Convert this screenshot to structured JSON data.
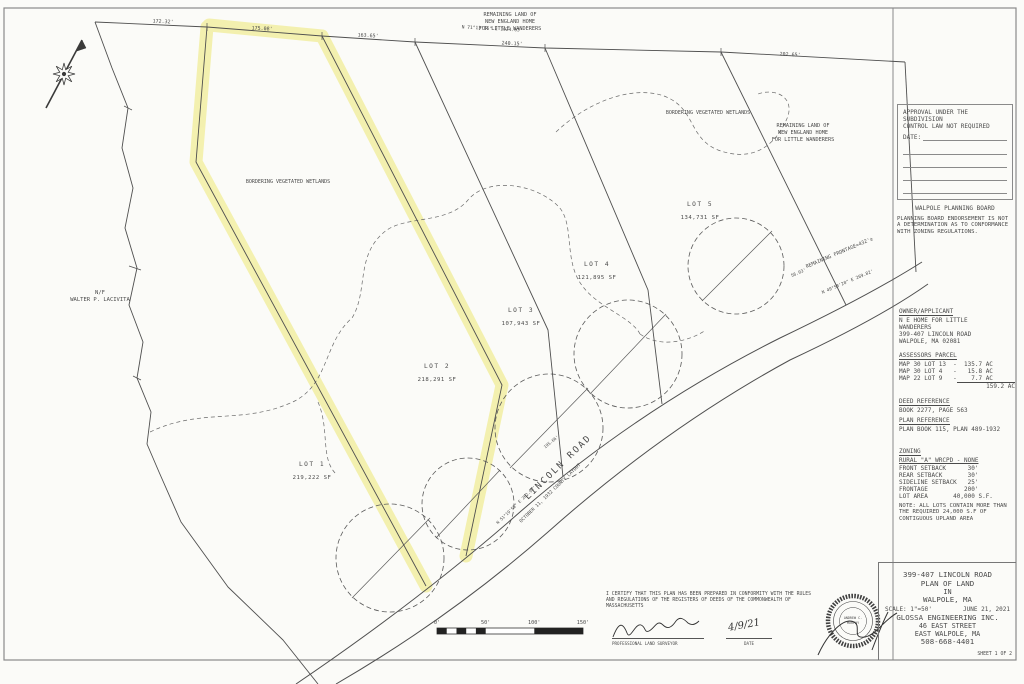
{
  "approval": {
    "line1": "APPROVAL UNDER THE SUBDIVISION",
    "line2": "CONTROL LAW NOT REQUIRED",
    "date_label": "DATE:",
    "board": "WALPOLE PLANNING BOARD",
    "endorsement": "PLANNING BOARD ENDORSEMENT IS NOT A DETERMINATION AS TO CONFORMANCE WITH ZONING REGULATIONS."
  },
  "owner": {
    "heading": "OWNER/APPLICANT",
    "lines": [
      "N E HOME FOR LITTLE",
      "WANDERERS",
      "399-407 LINCOLN ROAD",
      "WALPOLE, MA 02081"
    ]
  },
  "assessors": {
    "heading": "ASSESSORS PARCEL",
    "rows": [
      "MAP 30 LOT 13  -  135.7 AC",
      "MAP 30 LOT 4   -   15.8 AC",
      "MAP 22 LOT 9   -    7.7 AC"
    ],
    "total": "159.2 AC"
  },
  "deed": {
    "heading": "DEED REFERENCE",
    "value": "BOOK 2277, PAGE 563"
  },
  "plan_ref": {
    "heading": "PLAN REFERENCE",
    "value": "PLAN BOOK 115, PLAN 489-1932"
  },
  "zoning": {
    "heading": "ZONING",
    "district": "RURAL \"A\"  WRCPD - NONE",
    "rows": [
      "FRONT SETBACK      30'",
      "REAR SETBACK       30'",
      "SIDELINE SETBACK   25'",
      "FRONTAGE          200'",
      "LOT AREA       40,000 S.F."
    ],
    "note": "NOTE: ALL LOTS CONTAIN MORE THAN THE REQUIRED 24,000 S.F OF CONTIGUOUS UPLAND AREA"
  },
  "title_block": {
    "line1": "399-407 LINCOLN ROAD",
    "line2": "PLAN OF LAND",
    "line3": "IN",
    "line4": "WALPOLE, MA",
    "scale": "SCALE: 1\"=50'",
    "date": "JUNE 21, 2021",
    "firm": "GLOSSA ENGINEERING INC.",
    "address1": "46 EAST STREET",
    "address2": "EAST WALPOLE, MA",
    "phone": "508-668-4401",
    "sheet": "SHEET 1 OF 2"
  },
  "certification": {
    "text": "I CERTIFY THAT THIS PLAN HAS BEEN PREPARED IN CONFORMITY WITH THE RULES AND REGULATIONS OF THE REGISTERS OF DEEDS OF THE COMMONWEALTH OF MASSACHUSETTS",
    "surveyor_label": "PROFESSIONAL LAND SURVEYOR",
    "date_label": "DATE",
    "date_value": "4/9/21",
    "seal_line1": "ANDREW C.",
    "seal_line2": "MURPHY"
  },
  "scale_bar": {
    "ticks": [
      "0'",
      "50'",
      "100'",
      "150'"
    ]
  },
  "drawing": {
    "colors": {
      "highlight": "#f2efa3",
      "line": "#555555"
    },
    "lots": [
      {
        "name": "LOT 1",
        "area": "219,222 SF",
        "x": 312,
        "y": 466
      },
      {
        "name": "LOT 2",
        "area": "218,291 SF",
        "x": 437,
        "y": 368
      },
      {
        "name": "LOT 3",
        "area": "107,943 SF",
        "x": 521,
        "y": 312
      },
      {
        "name": "LOT 4",
        "area": "121,895 SF",
        "x": 597,
        "y": 266
      },
      {
        "name": "LOT 5",
        "area": "134,731 SF",
        "x": 700,
        "y": 206
      }
    ],
    "labels": [
      {
        "text": "REMAINING LAND OF",
        "x": 510,
        "y": 16,
        "s": 5.2
      },
      {
        "text": "NEW ENGLAND HOME",
        "x": 510,
        "y": 23,
        "s": 5.2
      },
      {
        "text": "FOR LITTLE WANDERERS",
        "x": 510,
        "y": 30,
        "s": 5.2
      },
      {
        "text": "REMAINING LAND OF",
        "x": 803,
        "y": 127,
        "s": 5.2
      },
      {
        "text": "NEW ENGLAND HOME",
        "x": 803,
        "y": 134,
        "s": 5.2
      },
      {
        "text": "FOR LITTLE WANDERERS",
        "x": 803,
        "y": 141,
        "s": 5.2
      },
      {
        "text": "BORDERING VEGETATED WETLANDS",
        "x": 288,
        "y": 183,
        "s": 5
      },
      {
        "text": "BORDERING VEGETATED WETLANDS",
        "x": 708,
        "y": 114,
        "s": 5
      },
      {
        "text": "N/F",
        "x": 100,
        "y": 294,
        "s": 5.5
      },
      {
        "text": "WALTER P. LACIVITA",
        "x": 100,
        "y": 301,
        "s": 5.5
      },
      {
        "text": "172.32'",
        "x": 163,
        "y": 23,
        "s": 5,
        "r": 3
      },
      {
        "text": "175.08'",
        "x": 262,
        "y": 30,
        "s": 5,
        "r": 3
      },
      {
        "text": "163.65'",
        "x": 368,
        "y": 37,
        "s": 5,
        "r": 3
      },
      {
        "text": "N 71°13'36\" E   1024.63'",
        "x": 492,
        "y": 30,
        "s": 4.6,
        "r": 3
      },
      {
        "text": "240.15'",
        "x": 512,
        "y": 45,
        "s": 5,
        "r": 3
      },
      {
        "text": "202.65'",
        "x": 790,
        "y": 56,
        "s": 5,
        "r": 3
      },
      {
        "text": "REMAINING FRONTAGE=432'±",
        "x": 840,
        "y": 254,
        "s": 5,
        "r": -23
      },
      {
        "text": "N 49°58'20\" E  269.82'",
        "x": 848,
        "y": 283,
        "s": 4.4,
        "r": -23
      },
      {
        "text": "56.03'",
        "x": 799,
        "y": 274,
        "s": 4.4,
        "r": -23
      },
      {
        "text": "LINCOLN ROAD",
        "x": 560,
        "y": 469,
        "s": 9,
        "r": -44,
        "ls": 2
      },
      {
        "text": "OCTOBER 11, 1932 COUNTY LAYOUT",
        "x": 551,
        "y": 494,
        "s": 4.6,
        "r": -44
      },
      {
        "text": "N 51°19'58\" E  202.92'",
        "x": 517,
        "y": 506,
        "s": 4.2,
        "r": -44
      },
      {
        "text": "195.66'",
        "x": 552,
        "y": 443,
        "s": 4.2,
        "r": -40
      }
    ]
  }
}
